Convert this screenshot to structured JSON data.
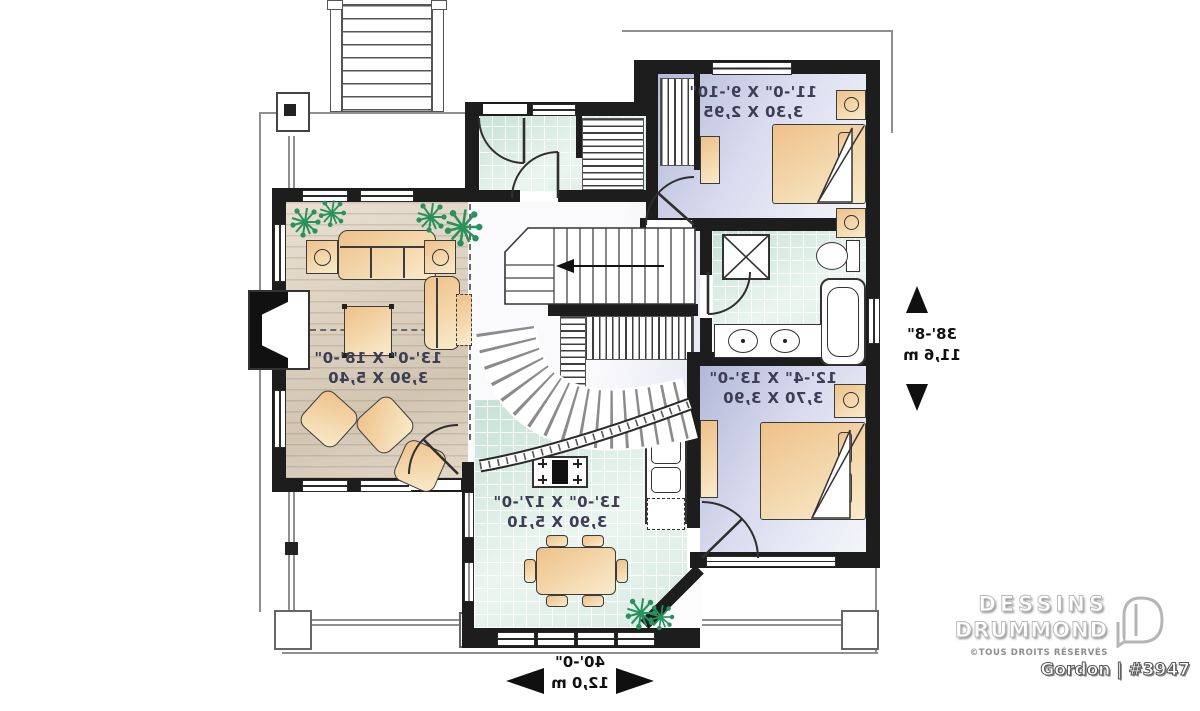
{
  "rooms": {
    "living": {
      "imperial": "13'-0\" X 18'-0\"",
      "metric": "3,90 X 5,40"
    },
    "kitchen": {
      "imperial": "13'-0\" X 17'-0\"",
      "metric": "3,90 X 5,10"
    },
    "bedroom2": {
      "imperial": "11'-0\" X 9'-10\"",
      "metric": "3,30 X 2,95"
    },
    "master": {
      "imperial": "12'-4\" X 13'-0\"",
      "metric": "3,70 X 3,90"
    }
  },
  "overall": {
    "depth_ft": "38'-8\"",
    "depth_m": "11,6 m",
    "width_ft": "40'-0\"",
    "width_m": "12,0 m"
  },
  "branding": {
    "line1": "DESSINS",
    "line2": "DRUMMOND",
    "copyright": "©TOUS DROITS RÉSERVÉS",
    "plan": "Gordon | #3947"
  },
  "palette": {
    "wall": "#1d1d1d",
    "wood_floor": "#d9cdbb",
    "tile_floor": "#cfe7dc",
    "bedroom_floor": "#bcc1e0",
    "furniture": "#f2cd92",
    "plant": "#27925c"
  }
}
